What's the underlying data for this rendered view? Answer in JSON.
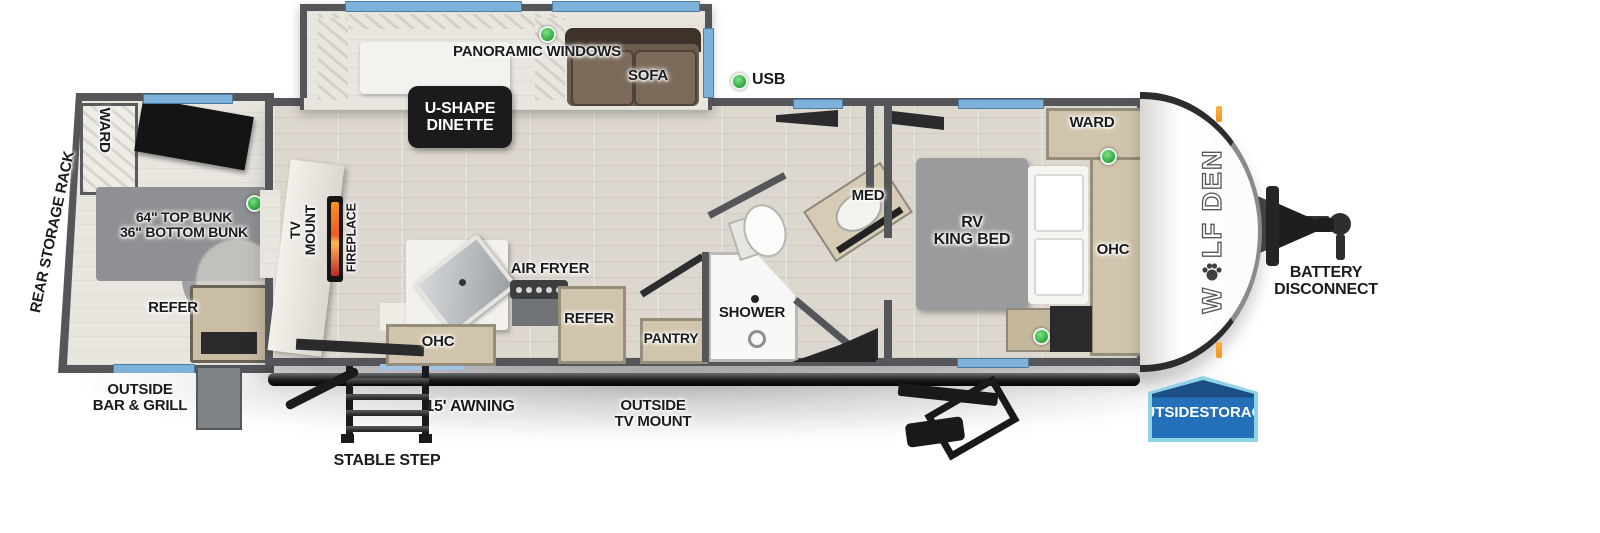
{
  "brand": {
    "name": "WOLF DEN",
    "part1": "W",
    "part2": "LF DEN"
  },
  "legend": {
    "usb": "USB"
  },
  "labels": {
    "panoramic_windows": "PANORAMIC WINDOWS",
    "dinette_line1": "U-SHAPE",
    "dinette_line2": "DINETTE",
    "sofa": "SOFA",
    "rear_storage_rack": "REAR STORAGE RACK",
    "ward_rear": "WARD",
    "bunk_line1": "64\" TOP BUNK",
    "bunk_line2": "36\" BOTTOM BUNK",
    "refer_rear": "REFER",
    "tv_mount_line1": "TV",
    "tv_mount_line2": "MOUNT",
    "fireplace": "FIREPLACE",
    "air_fryer": "AIR FRYER",
    "ohc_kitchen": "OHC",
    "refer_kitchen": "REFER",
    "pantry": "PANTRY",
    "shower": "SHOWER",
    "med": "MED",
    "king_bed_line1": "RV",
    "king_bed_line2": "KING BED",
    "ward_front": "WARD",
    "ohc_front": "OHC",
    "battery_line1": "BATTERY",
    "battery_line2": "DISCONNECT",
    "outside_storage_line1": "OUTSIDE",
    "outside_storage_line2": "STORAGE",
    "outside_bar_line1": "OUTSIDE",
    "outside_bar_line2": "BAR & GRILL",
    "awning": "15' AWNING",
    "stable_step": "STABLE STEP",
    "outside_tv_line1": "OUTSIDE",
    "outside_tv_line2": "TV MOUNT"
  },
  "colors": {
    "wall": "#55565a",
    "floor": "#dcd7cf",
    "window_blue": "#7fb2da",
    "led_green": "#3db54a",
    "fireplace_orange": "#f15a24",
    "storage_badge_blue": "#2470b8",
    "storage_badge_border": "#8fd4e6",
    "sofa_brown": "#6b5c4e",
    "cabinet_tan": "#d0c4ac",
    "label_text": "#1b1b1d"
  }
}
